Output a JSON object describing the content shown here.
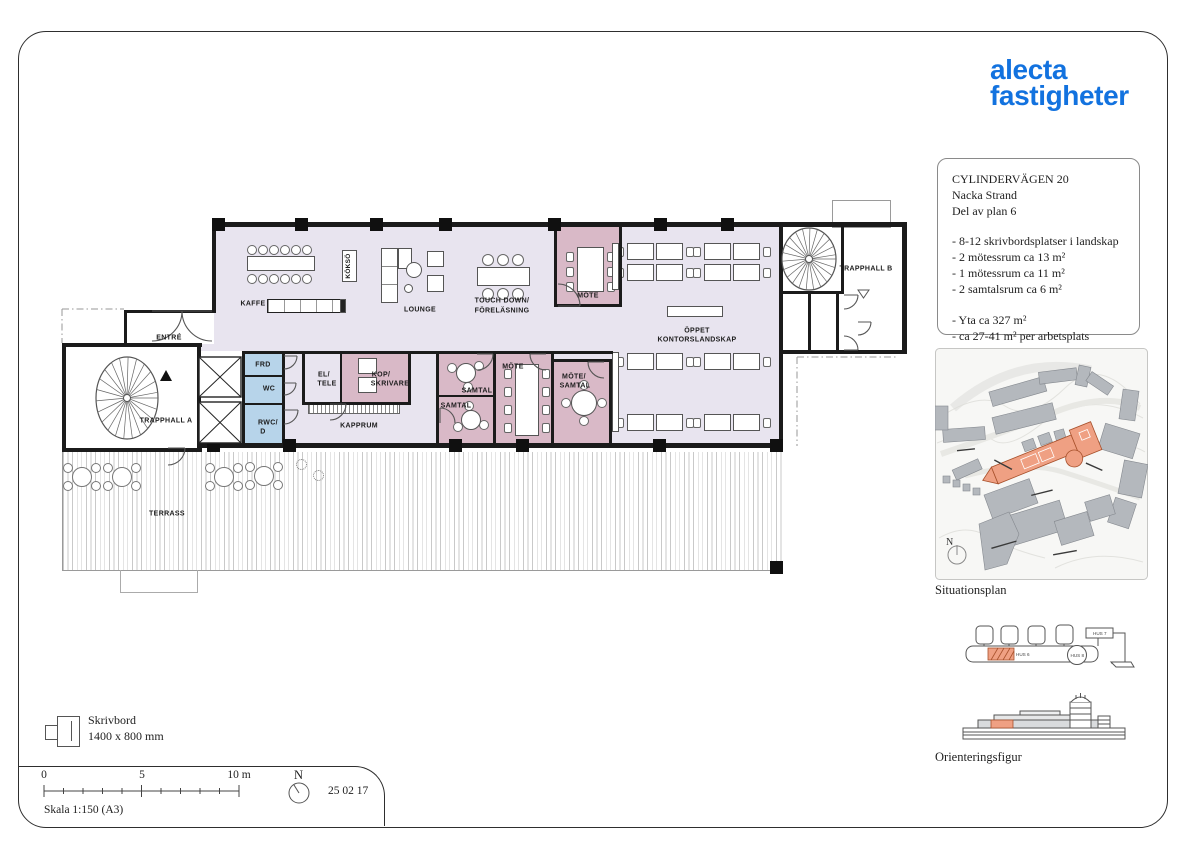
{
  "logo": {
    "line1": "alecta",
    "line2": "fastigheter",
    "color": "#1272df"
  },
  "title_block": {
    "address": "CYLINDERVÄGEN 20",
    "location": "Nacka Strand",
    "floor": "Del av plan 6",
    "features": [
      "- 8-12 skrivbordsplatser i landskap",
      "- 2 mötessrum ca 13 m²",
      "- 1 mötessrum ca 11 m²",
      "- 2 samtalsrum ca 6 m²"
    ],
    "totals": [
      "- Yta ca 327 m²",
      "- ca 27-41 m² per arbetsplats"
    ]
  },
  "plan_labels": {
    "kaffe": "KAFFE",
    "kokso": "KÖKSÖ",
    "lounge": "LOUNGE",
    "touch_down_line1": "TOUCH DOWN/",
    "touch_down_line2": "FÖRELÄSNING",
    "mote_top": "MÖTE",
    "oppet_line1": "ÖPPET",
    "oppet_line2": "KONTORSLANDSKAP",
    "trapphall_b": "TRAPPHALL B",
    "entre": "ENTRÉ",
    "trapphall_a": "TRAPPHALL A",
    "frd": "FRD",
    "wc": "WC",
    "rwc_line1": "RWC/",
    "rwc_line2": "D",
    "el_tele_line1": "EL/",
    "el_tele_line2": "TELE",
    "kop_line1": "KOP/",
    "kop_line2": "SKRIVARE",
    "samtal_upper": "SAMTAL",
    "samtal_lower": "SAMTAL",
    "mote_mid": "MÖTE",
    "mote_samtal_line1": "MÖTE/",
    "mote_samtal_line2": "SAMTAL",
    "kapprum": "KAPPRUM",
    "terrass": "TERRASS"
  },
  "legend": {
    "desk_label": "Skrivbord",
    "desk_dimensions": "1400 x 800 mm",
    "scale_text": "Skala 1:150 (A3)",
    "scale_tick_0": "0",
    "scale_tick_5": "5",
    "scale_tick_10": "10 m",
    "north_label": "N",
    "date": "25 02 17"
  },
  "sidebar": {
    "situationsplan_caption": "Situationsplan",
    "orientering_caption": "Orienteringsfigur",
    "north_label": "N",
    "hus_labels": {
      "hus6": "HUS 6",
      "hus7": "HUS 7",
      "hus8": "HUS 8"
    }
  },
  "colors": {
    "logo_blue": "#1272df",
    "floor_lavender": "#e8e4ef",
    "meeting_pink": "#d9b9c7",
    "wet_room_blue": "#b7d4ea",
    "highlight_orange": "#efa083",
    "wall": "#1b1b1b"
  }
}
